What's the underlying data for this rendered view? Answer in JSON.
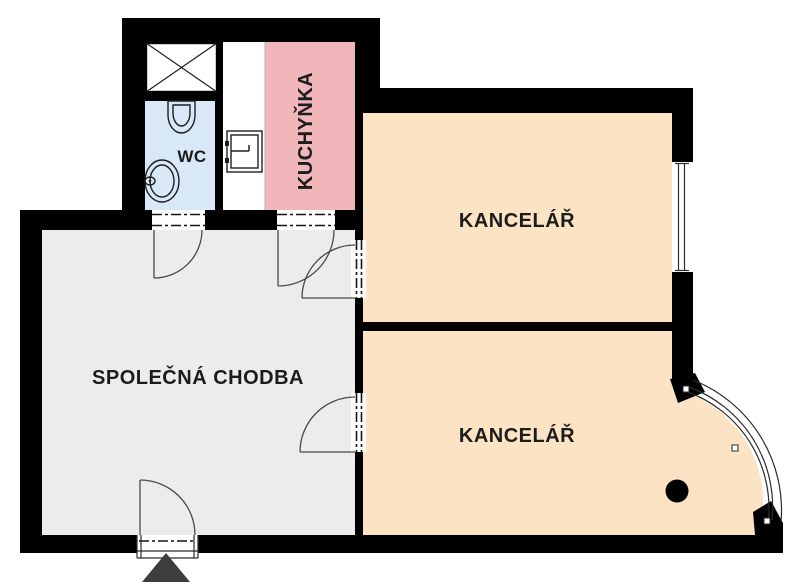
{
  "plan": {
    "background": "#ffffff",
    "colors": {
      "wall": "#000000",
      "corridor_floor": "#ececec",
      "office_floor": "#fce3c4",
      "kitchen_floor": "#f1b6ba",
      "wc_floor": "#d9e8f6",
      "utility_floor": "#ffffff",
      "door_swing": "#4a4a4a",
      "entrance_marker": "#3d3d3d",
      "column": "#000000"
    },
    "rooms": {
      "corridor": {
        "label": "SPOLEČNÁ CHODBA"
      },
      "wc": {
        "label": "WC"
      },
      "kitchen": {
        "label": "KUCHYŇKA"
      },
      "office_top": {
        "label": "KANCELÁŘ"
      },
      "office_bottom": {
        "label": "KANCELÁŘ"
      }
    },
    "fixtures": {
      "shower": "shower-bay-icon",
      "toilet": "toilet-icon",
      "washbasin": "washbasin-icon",
      "kitchen_sink": "kitchen-sink-icon",
      "column": "column-dot-icon",
      "entrance": "entrance-triangle-icon",
      "window_straight": "window-icon",
      "window_curved": "curved-window-icon",
      "door": "door-swing-icon"
    }
  }
}
